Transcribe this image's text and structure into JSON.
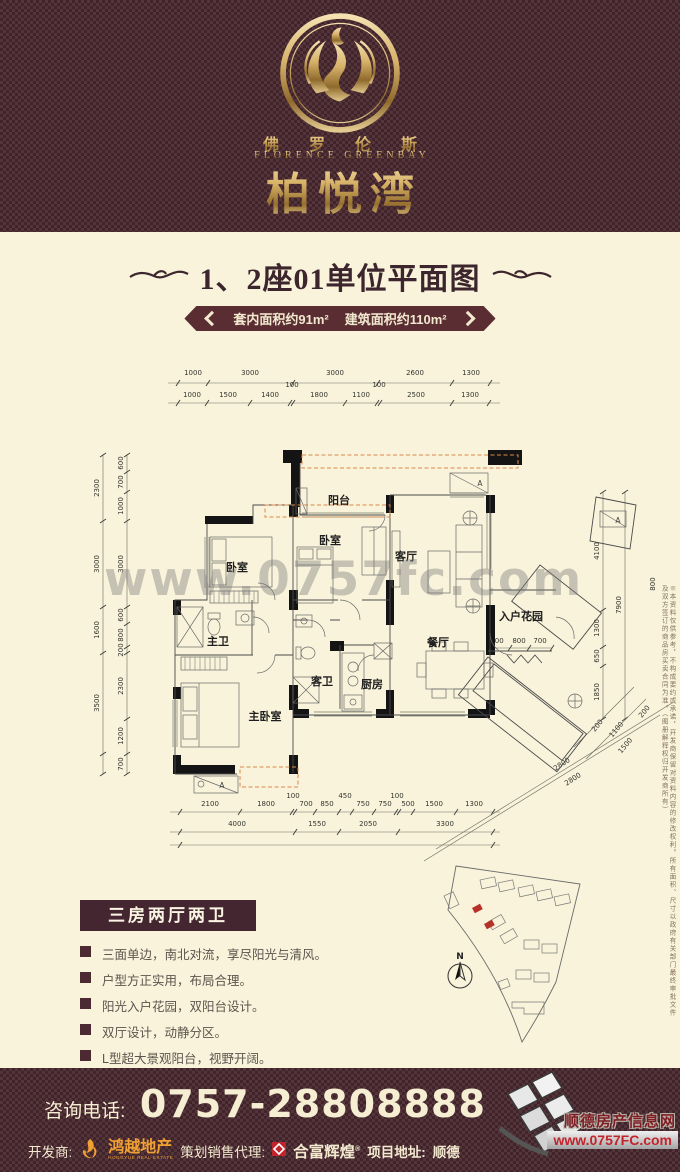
{
  "header": {
    "brand_cn": "佛 罗 伦 斯",
    "brand_en": "FLORENCE GREENBAY",
    "brand_name": "柏悦湾"
  },
  "title": "1、2座01单位平面图",
  "banner": {
    "interior_area": "套内面积约91m²",
    "gross_area": "建筑面积约110m²"
  },
  "watermark": "www.0757fc.com",
  "plan": {
    "rooms": {
      "balcony": "阳台",
      "bedroom_top": "卧室",
      "bedroom_left": "卧室",
      "living": "客厅",
      "dining": "餐厅",
      "kitchen": "厨房",
      "master_bath": "主卫",
      "guest_bath": "客卫",
      "master_bedroom": "主卧室",
      "entry_garden": "入户花园"
    },
    "door_marker": "A",
    "dims": {
      "top_row1": [
        "1000",
        "3000",
        "3000",
        "2600",
        "1300"
      ],
      "top_row2": [
        "1000",
        "1500",
        "1400",
        "100",
        "1800",
        "1100",
        "100",
        "2500",
        "1300"
      ],
      "left_outer": [
        "2300",
        "3000",
        "1600",
        "3500"
      ],
      "left_inner": [
        "600",
        "700",
        "1000",
        "3000",
        "600",
        "800",
        "200",
        "2300",
        "1200",
        "700"
      ],
      "right_inner": [
        "4100",
        "1300",
        "650",
        "1850"
      ],
      "right_total": "7900",
      "diag": [
        "200",
        "1100",
        "200",
        "1500",
        "2800",
        "2800"
      ],
      "bottom_row1": [
        "2100",
        "1800",
        "100",
        "700",
        "850",
        "450",
        "750",
        "750",
        "100",
        "500",
        "1500",
        "1300"
      ],
      "bottom_row2": [
        "4000",
        "1550",
        "2050",
        "3300"
      ],
      "garden": [
        "800",
        "800",
        "700"
      ],
      "top_right": "800"
    }
  },
  "features": {
    "title": "三房两厅两卫",
    "items": [
      "三面单边，南北对流，享尽阳光与清风。",
      "户型方正实用，布局合理。",
      "阳光入户花园，双阳台设计。",
      "双厅设计，动静分区。",
      "L型超大景观阳台，视野开阔。"
    ]
  },
  "siteplan": {
    "north": "N"
  },
  "disclaimer": "※本资料仅供参考，不构成要约或承诺，开发商保留对资料内容的修改权利。所有面积、尺寸以政府有关部门最终审批文件及双方签订的商品房买卖合同为准。（图册解释权归开发商所有）",
  "footer": {
    "phone_label": "咨询电话:",
    "phone_number": "0757-28808888",
    "developer_label": "开发商:",
    "developer_name": "鸿越地产",
    "developer_sub": "HONGYUE REAL ESTATE",
    "agent_label": "策划销售代理:",
    "agent_name": "合富辉煌",
    "reg_mark": "®",
    "address_label": "项目地址:",
    "address_value": "顺德",
    "site_name": "顺德房产信息网",
    "site_url": "www.0757FC.com"
  }
}
